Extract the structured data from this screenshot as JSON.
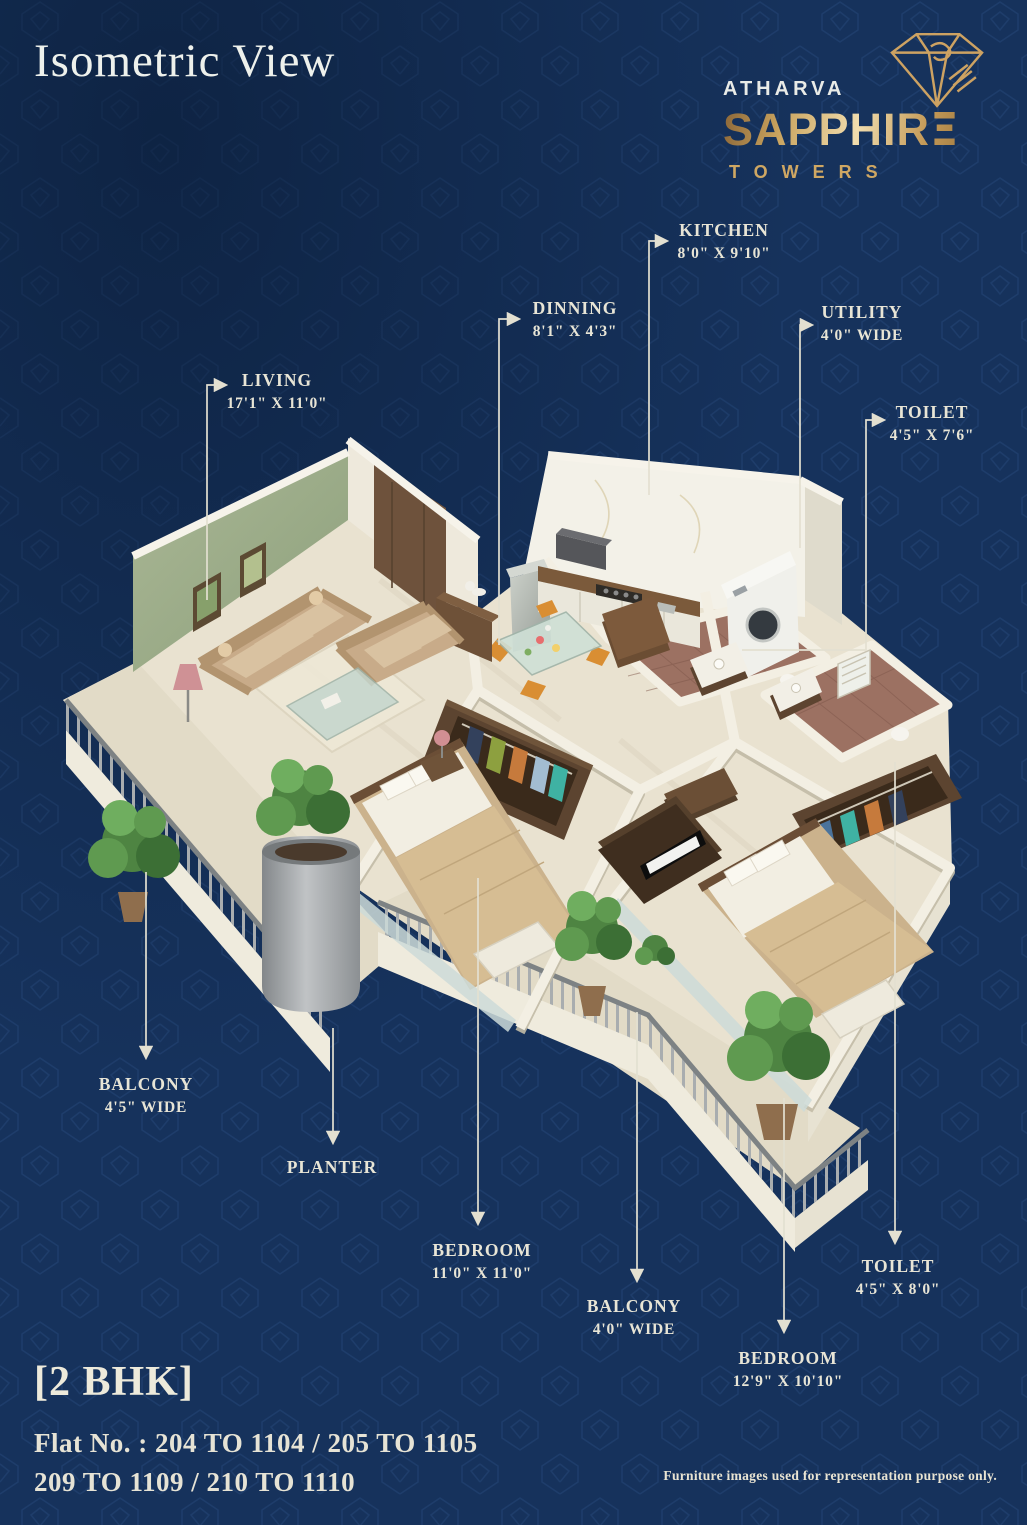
{
  "title": "Isometric View",
  "brand": {
    "atharva": "ATHARVA",
    "sapphire": "SAPPHIRE",
    "towers": "TOWERS",
    "icon": "diamond-outline-icon"
  },
  "labels": [
    {
      "id": "living",
      "name": "LIVING",
      "dims": "17'1\" X 11'0\""
    },
    {
      "id": "dinning",
      "name": "DINNING",
      "dims": "8'1\" X 4'3\""
    },
    {
      "id": "kitchen",
      "name": "KITCHEN",
      "dims": "8'0\" X 9'10\""
    },
    {
      "id": "utility",
      "name": "UTILITY",
      "dims": "4'0\" WIDE"
    },
    {
      "id": "toilet-top",
      "name": "TOILET",
      "dims": "4'5\" X 7'6\""
    },
    {
      "id": "balcony-left",
      "name": "BALCONY",
      "dims": "4'5\" WIDE"
    },
    {
      "id": "planter",
      "name": "PLANTER",
      "dims": ""
    },
    {
      "id": "bedroom-left",
      "name": "BEDROOM",
      "dims": "11'0\" X 11'0\""
    },
    {
      "id": "balcony-mid",
      "name": "BALCONY",
      "dims": "4'0\" WIDE"
    },
    {
      "id": "toilet-bottom",
      "name": "TOILET",
      "dims": "4'5\" X 8'0\""
    },
    {
      "id": "bedroom-right",
      "name": "BEDROOM",
      "dims": "12'9\" X 10'10\""
    }
  ],
  "footer": {
    "unit_type": "[2 BHK]",
    "flat_line1": "Flat No. : 204 TO 1104 / 205 TO 1105",
    "flat_line2": "209 TO 1109 / 210 TO 1110",
    "disclaimer": "Furniture images used for representation purpose only."
  },
  "colors": {
    "background": "#16325c",
    "pattern_line": "#3a639e",
    "label_text": "#e8e5d6",
    "gold": "#c9a15e",
    "gold_light": "#eed9a6",
    "title_text": "#eef1ec"
  }
}
